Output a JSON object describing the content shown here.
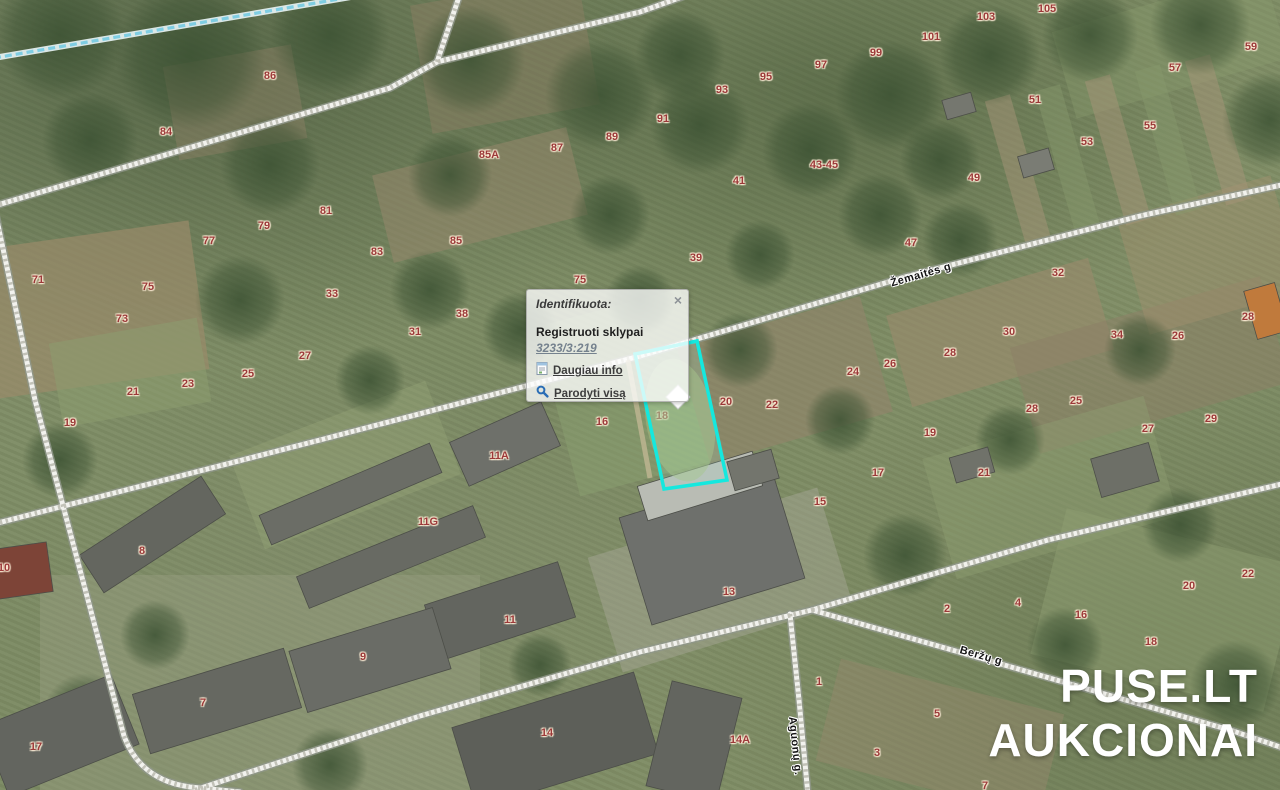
{
  "map": {
    "width": 1280,
    "height": 790
  },
  "popup": {
    "title": "Identifikuota:",
    "close_label": "×",
    "layer_heading": "Registruoti sklypai",
    "parcel_link": "3233/3:219",
    "more_info_label": "Daugiau info",
    "show_all_label": "Parodyti visą"
  },
  "watermark": {
    "line1": "PUSE.LT",
    "line2": "AUKCIONAI"
  },
  "streets": [
    {
      "name": "Žemaitės g",
      "x": 921,
      "y": 275,
      "angle": -16
    },
    {
      "name": "Beržų g",
      "x": 981,
      "y": 656,
      "angle": 16
    },
    {
      "name": "Aguonų g.",
      "x": 795,
      "y": 746,
      "angle": 84
    }
  ],
  "highlight": {
    "points": "635,354 697,341 727,480 664,489",
    "marker": {
      "x": 678,
      "y": 397,
      "r": 12
    },
    "color": "#15e8de"
  },
  "parcel_labels": [
    {
      "t": "86",
      "x": 270,
      "y": 76
    },
    {
      "t": "84",
      "x": 166,
      "y": 132
    },
    {
      "t": "85A",
      "x": 489,
      "y": 155
    },
    {
      "t": "87",
      "x": 557,
      "y": 148
    },
    {
      "t": "89",
      "x": 612,
      "y": 137
    },
    {
      "t": "91",
      "x": 663,
      "y": 119
    },
    {
      "t": "93",
      "x": 722,
      "y": 90
    },
    {
      "t": "95",
      "x": 766,
      "y": 77
    },
    {
      "t": "97",
      "x": 821,
      "y": 65
    },
    {
      "t": "99",
      "x": 876,
      "y": 53
    },
    {
      "t": "101",
      "x": 931,
      "y": 37
    },
    {
      "t": "103",
      "x": 986,
      "y": 17
    },
    {
      "t": "105",
      "x": 1047,
      "y": 9
    },
    {
      "t": "59",
      "x": 1251,
      "y": 47
    },
    {
      "t": "57",
      "x": 1175,
      "y": 68
    },
    {
      "t": "51",
      "x": 1035,
      "y": 100
    },
    {
      "t": "55",
      "x": 1150,
      "y": 126
    },
    {
      "t": "53",
      "x": 1087,
      "y": 142
    },
    {
      "t": "49",
      "x": 974,
      "y": 178
    },
    {
      "t": "43-45",
      "x": 824,
      "y": 165
    },
    {
      "t": "41",
      "x": 739,
      "y": 181
    },
    {
      "t": "71",
      "x": 38,
      "y": 280
    },
    {
      "t": "75",
      "x": 148,
      "y": 287
    },
    {
      "t": "73",
      "x": 122,
      "y": 319
    },
    {
      "t": "77",
      "x": 209,
      "y": 241
    },
    {
      "t": "79",
      "x": 264,
      "y": 226
    },
    {
      "t": "81",
      "x": 326,
      "y": 211
    },
    {
      "t": "83",
      "x": 377,
      "y": 252
    },
    {
      "t": "85",
      "x": 456,
      "y": 241
    },
    {
      "t": "75",
      "x": 580,
      "y": 280
    },
    {
      "t": "33",
      "x": 332,
      "y": 294
    },
    {
      "t": "31",
      "x": 415,
      "y": 332
    },
    {
      "t": "38",
      "x": 462,
      "y": 314
    },
    {
      "t": "27",
      "x": 305,
      "y": 356
    },
    {
      "t": "25",
      "x": 248,
      "y": 374
    },
    {
      "t": "23",
      "x": 188,
      "y": 384
    },
    {
      "t": "21",
      "x": 133,
      "y": 392
    },
    {
      "t": "19",
      "x": 70,
      "y": 423
    },
    {
      "t": "39",
      "x": 696,
      "y": 258
    },
    {
      "t": "47",
      "x": 911,
      "y": 243
    },
    {
      "t": "32",
      "x": 1058,
      "y": 273
    },
    {
      "t": "30",
      "x": 1009,
      "y": 332
    },
    {
      "t": "28",
      "x": 950,
      "y": 353
    },
    {
      "t": "26",
      "x": 890,
      "y": 364
    },
    {
      "t": "24",
      "x": 853,
      "y": 372
    },
    {
      "t": "34",
      "x": 1117,
      "y": 335
    },
    {
      "t": "26",
      "x": 1178,
      "y": 336
    },
    {
      "t": "28",
      "x": 1248,
      "y": 317
    },
    {
      "t": "28",
      "x": 1032,
      "y": 409
    },
    {
      "t": "25",
      "x": 1076,
      "y": 401
    },
    {
      "t": "27",
      "x": 1148,
      "y": 429
    },
    {
      "t": "29",
      "x": 1211,
      "y": 419
    },
    {
      "t": "16",
      "x": 602,
      "y": 422
    },
    {
      "t": "18",
      "x": 662,
      "y": 416
    },
    {
      "t": "20",
      "x": 726,
      "y": 402
    },
    {
      "t": "22",
      "x": 772,
      "y": 405
    },
    {
      "t": "19",
      "x": 930,
      "y": 433
    },
    {
      "t": "17",
      "x": 878,
      "y": 473
    },
    {
      "t": "21",
      "x": 984,
      "y": 473
    },
    {
      "t": "15",
      "x": 820,
      "y": 502
    },
    {
      "t": "11A",
      "x": 499,
      "y": 456
    },
    {
      "t": "11G",
      "x": 428,
      "y": 522
    },
    {
      "t": "8",
      "x": 142,
      "y": 551
    },
    {
      "t": "10",
      "x": 4,
      "y": 568
    },
    {
      "t": "13",
      "x": 729,
      "y": 592
    },
    {
      "t": "22",
      "x": 1248,
      "y": 574
    },
    {
      "t": "20",
      "x": 1189,
      "y": 586
    },
    {
      "t": "11",
      "x": 510,
      "y": 620
    },
    {
      "t": "9",
      "x": 363,
      "y": 657
    },
    {
      "t": "7",
      "x": 203,
      "y": 703
    },
    {
      "t": "17",
      "x": 36,
      "y": 747
    },
    {
      "t": "14",
      "x": 547,
      "y": 733
    },
    {
      "t": "2",
      "x": 947,
      "y": 609
    },
    {
      "t": "4",
      "x": 1018,
      "y": 603
    },
    {
      "t": "16",
      "x": 1081,
      "y": 615
    },
    {
      "t": "18",
      "x": 1151,
      "y": 642
    },
    {
      "t": "1",
      "x": 819,
      "y": 682
    },
    {
      "t": "14A",
      "x": 740,
      "y": 740
    },
    {
      "t": "5",
      "x": 937,
      "y": 714
    },
    {
      "t": "3",
      "x": 877,
      "y": 753
    },
    {
      "t": "7",
      "x": 985,
      "y": 786
    }
  ],
  "colors": {
    "highlight": "#15e8de",
    "parcel_number": "#9c3939",
    "street_label": "#141414",
    "watermark": "#ffffff",
    "icon_blue": "#2a6db5",
    "popup_background": "rgba(255,255,255,0.78)"
  }
}
